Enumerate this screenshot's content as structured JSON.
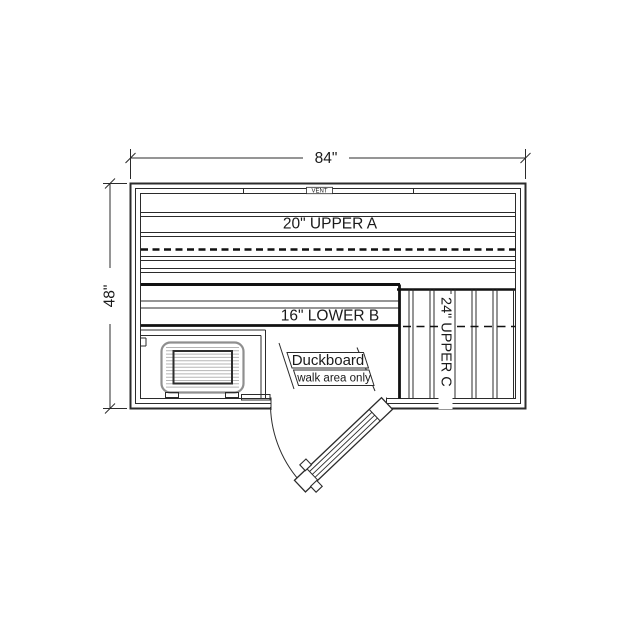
{
  "plan": {
    "width_dim": "84\"",
    "height_dim": "48\"",
    "vent": "VENT",
    "bench_a": "20\" UPPER A",
    "bench_b": "16\" LOWER B",
    "bench_c": "24\" UPPER C",
    "duckboard": {
      "title": "Duckboard",
      "subtitle": "walk area only"
    },
    "colors": {
      "line": "#2b2b2b",
      "bench_edge": "#111111",
      "heater_outline": "#8f8f8f",
      "heater_grille": "#b5b5b5",
      "background": "#ffffff",
      "text": "#1a1a1a"
    }
  }
}
